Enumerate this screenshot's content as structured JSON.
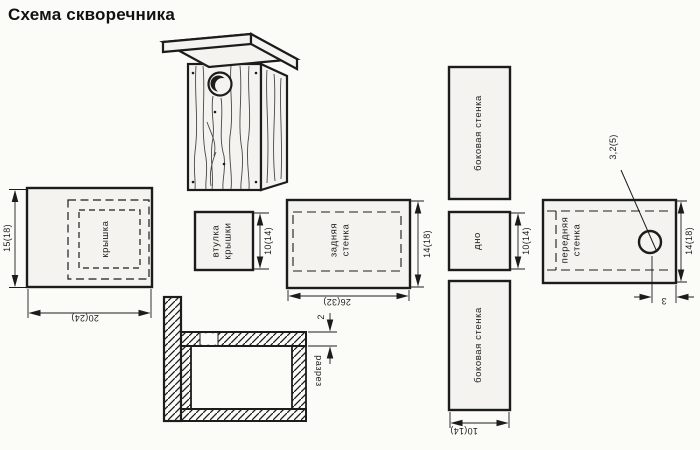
{
  "title": "Схема скворечника",
  "pieces": {
    "lid": {
      "label": "крышка",
      "height": "15(18)",
      "width": "20(24)"
    },
    "lid_bushing": {
      "label_line1": "втулка",
      "label_line2": "крышки",
      "size": "10(14)"
    },
    "back_wall": {
      "label_line1": "задняя",
      "label_line2": "стенка",
      "height": "14(18)",
      "width": "26(32)"
    },
    "side_wall_top": {
      "label": "боковая стенка"
    },
    "bottom": {
      "label": "дно",
      "size": "10(14)"
    },
    "side_wall_bottom": {
      "label": "боковая стенка",
      "width": "10(14)"
    },
    "front_wall": {
      "label_line1": "передняя",
      "label_line2": "стенка",
      "height": "14(18)",
      "hole_diameter": "3,2(5)",
      "hole_offset": "3"
    },
    "section": {
      "label": "разрез",
      "board_thickness": "2"
    }
  },
  "colors": {
    "line": "#1c1c1c",
    "paper": "#fbfbf8",
    "piece_fill": "#f4f3ef"
  }
}
